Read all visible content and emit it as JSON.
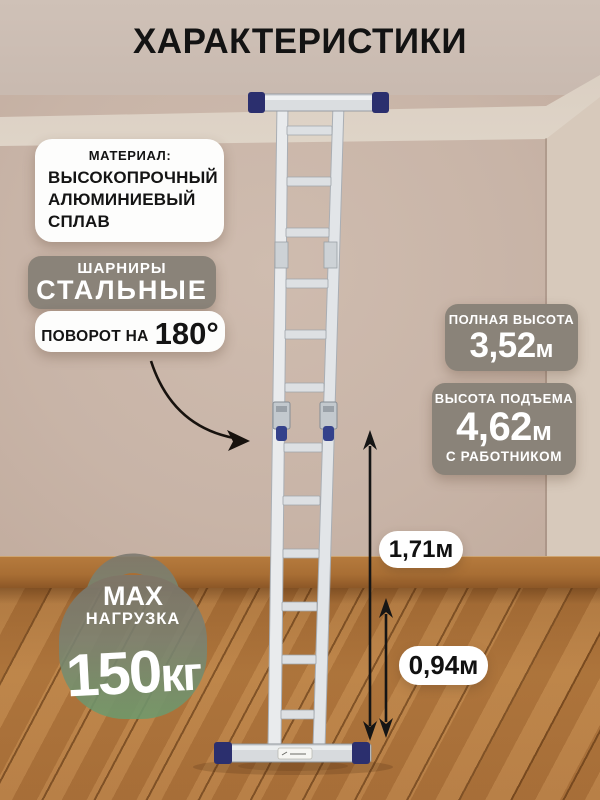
{
  "title": "ХАРАКТЕРИСТИКИ",
  "material": {
    "heading": "МАТЕРИАЛ:",
    "line1": "ВЫСОКОПРОЧНЫЙ",
    "line2": "АЛЮМИНИЕВЫЙ",
    "line3": "СПЛАВ"
  },
  "hinges": {
    "label_small": "ШАРНИРЫ",
    "label_big": "СТАЛЬНЫЕ",
    "rotation_prefix": "ПОВОРОТ НА",
    "rotation_value": "180°"
  },
  "full_height": {
    "label": "ПОЛНАЯ ВЫСОТА",
    "value": "3,52",
    "unit": "м"
  },
  "lift_height": {
    "label": "ВЫСОТА ПОДЪЕМА",
    "value": "4,62",
    "unit": "м",
    "note": "С РАБОТНИКОМ"
  },
  "dimensions": {
    "hinge_to_floor": "1,71м",
    "lower_section": "0,94м"
  },
  "max_load": {
    "line1": "MAX",
    "line2": "НАГРУЗКА",
    "value": "150",
    "unit": "кг"
  },
  "colors": {
    "badge_gray": "#8a8379",
    "pill_white": "#ffffff",
    "wall_beige": "#c8b4a7",
    "floor_wood": "#b0763e",
    "ladder_cap_navy": "#2b2f6e",
    "hinge_knob_blue": "#34418b",
    "kettlebell_green": "#6d9a6c",
    "text_black": "#141414"
  }
}
